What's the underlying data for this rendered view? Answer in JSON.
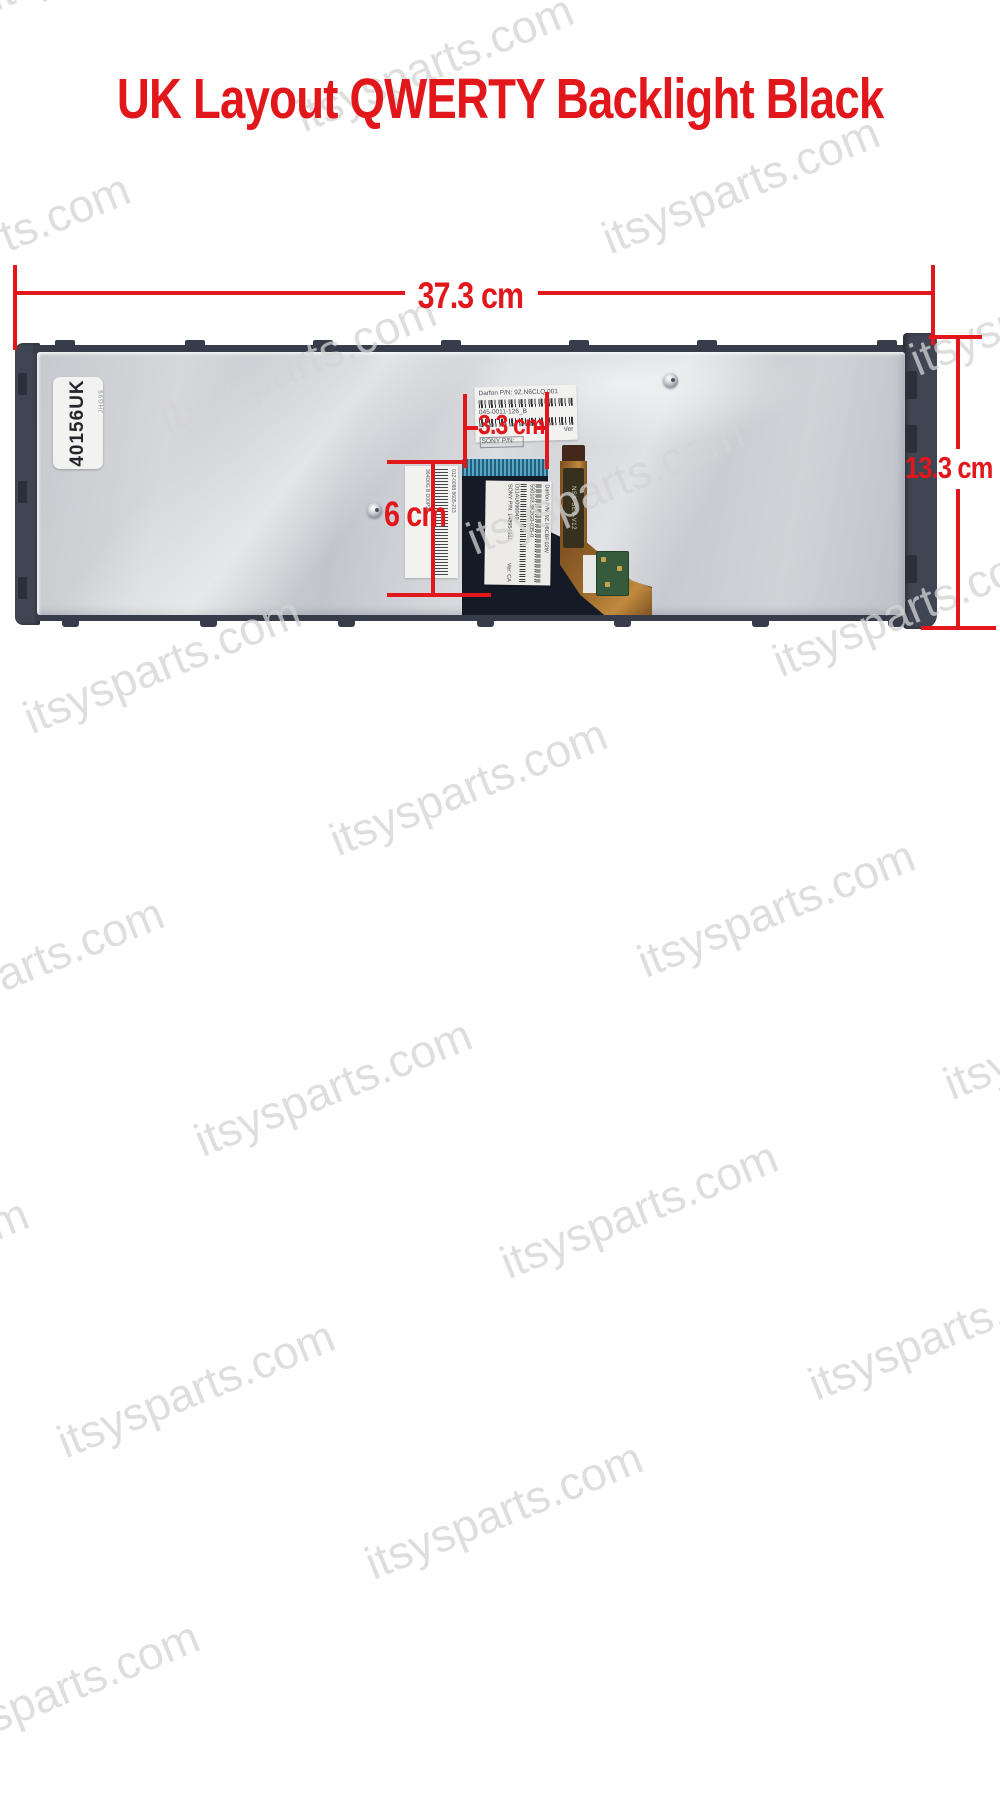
{
  "title": "UK Layout QWERTY Backlight Black",
  "watermark": {
    "text": "itsysparts.com"
  },
  "annotations": {
    "width": "37.3 cm",
    "height": "13.3 cm",
    "connector_offset": "3.3 cm",
    "ribbon_length": "6 cm"
  },
  "keyboard": {
    "id_label": "40156UK",
    "id_side_note": "JHG99",
    "top_sticker": {
      "lines": [
        "Darfon P/N: 9Z.N6CLQ.001",
        "045-0011-126_B",
        "Ver",
        "SONY P/N:"
      ]
    },
    "ribbon_sticker": {
      "lines": [
        "Darfon P/N: 9Z.N6CBF.02W",
        "550103.3K2G0-035-0",
        "D11AU090049",
        "SONY P/N: 148954911",
        "Ver: CA"
      ]
    },
    "left_sticker": {
      "lines": [
        "012-0088  8605-213",
        "364D0G B D00P9E"
      ]
    },
    "flex_cable_label": "NSK-SE0-V12"
  },
  "colors": {
    "accent": "#e2171c",
    "frame": "#3f4552",
    "frame_dark": "#2a2f3a",
    "plate": "#c9ccd1",
    "ribbon": "#151a27",
    "connector": "#3e85a5",
    "flex": "#9c682c",
    "pcb": "#355a3c",
    "sticker": "#f2f2f0",
    "watermark": "#d4d4d4"
  }
}
